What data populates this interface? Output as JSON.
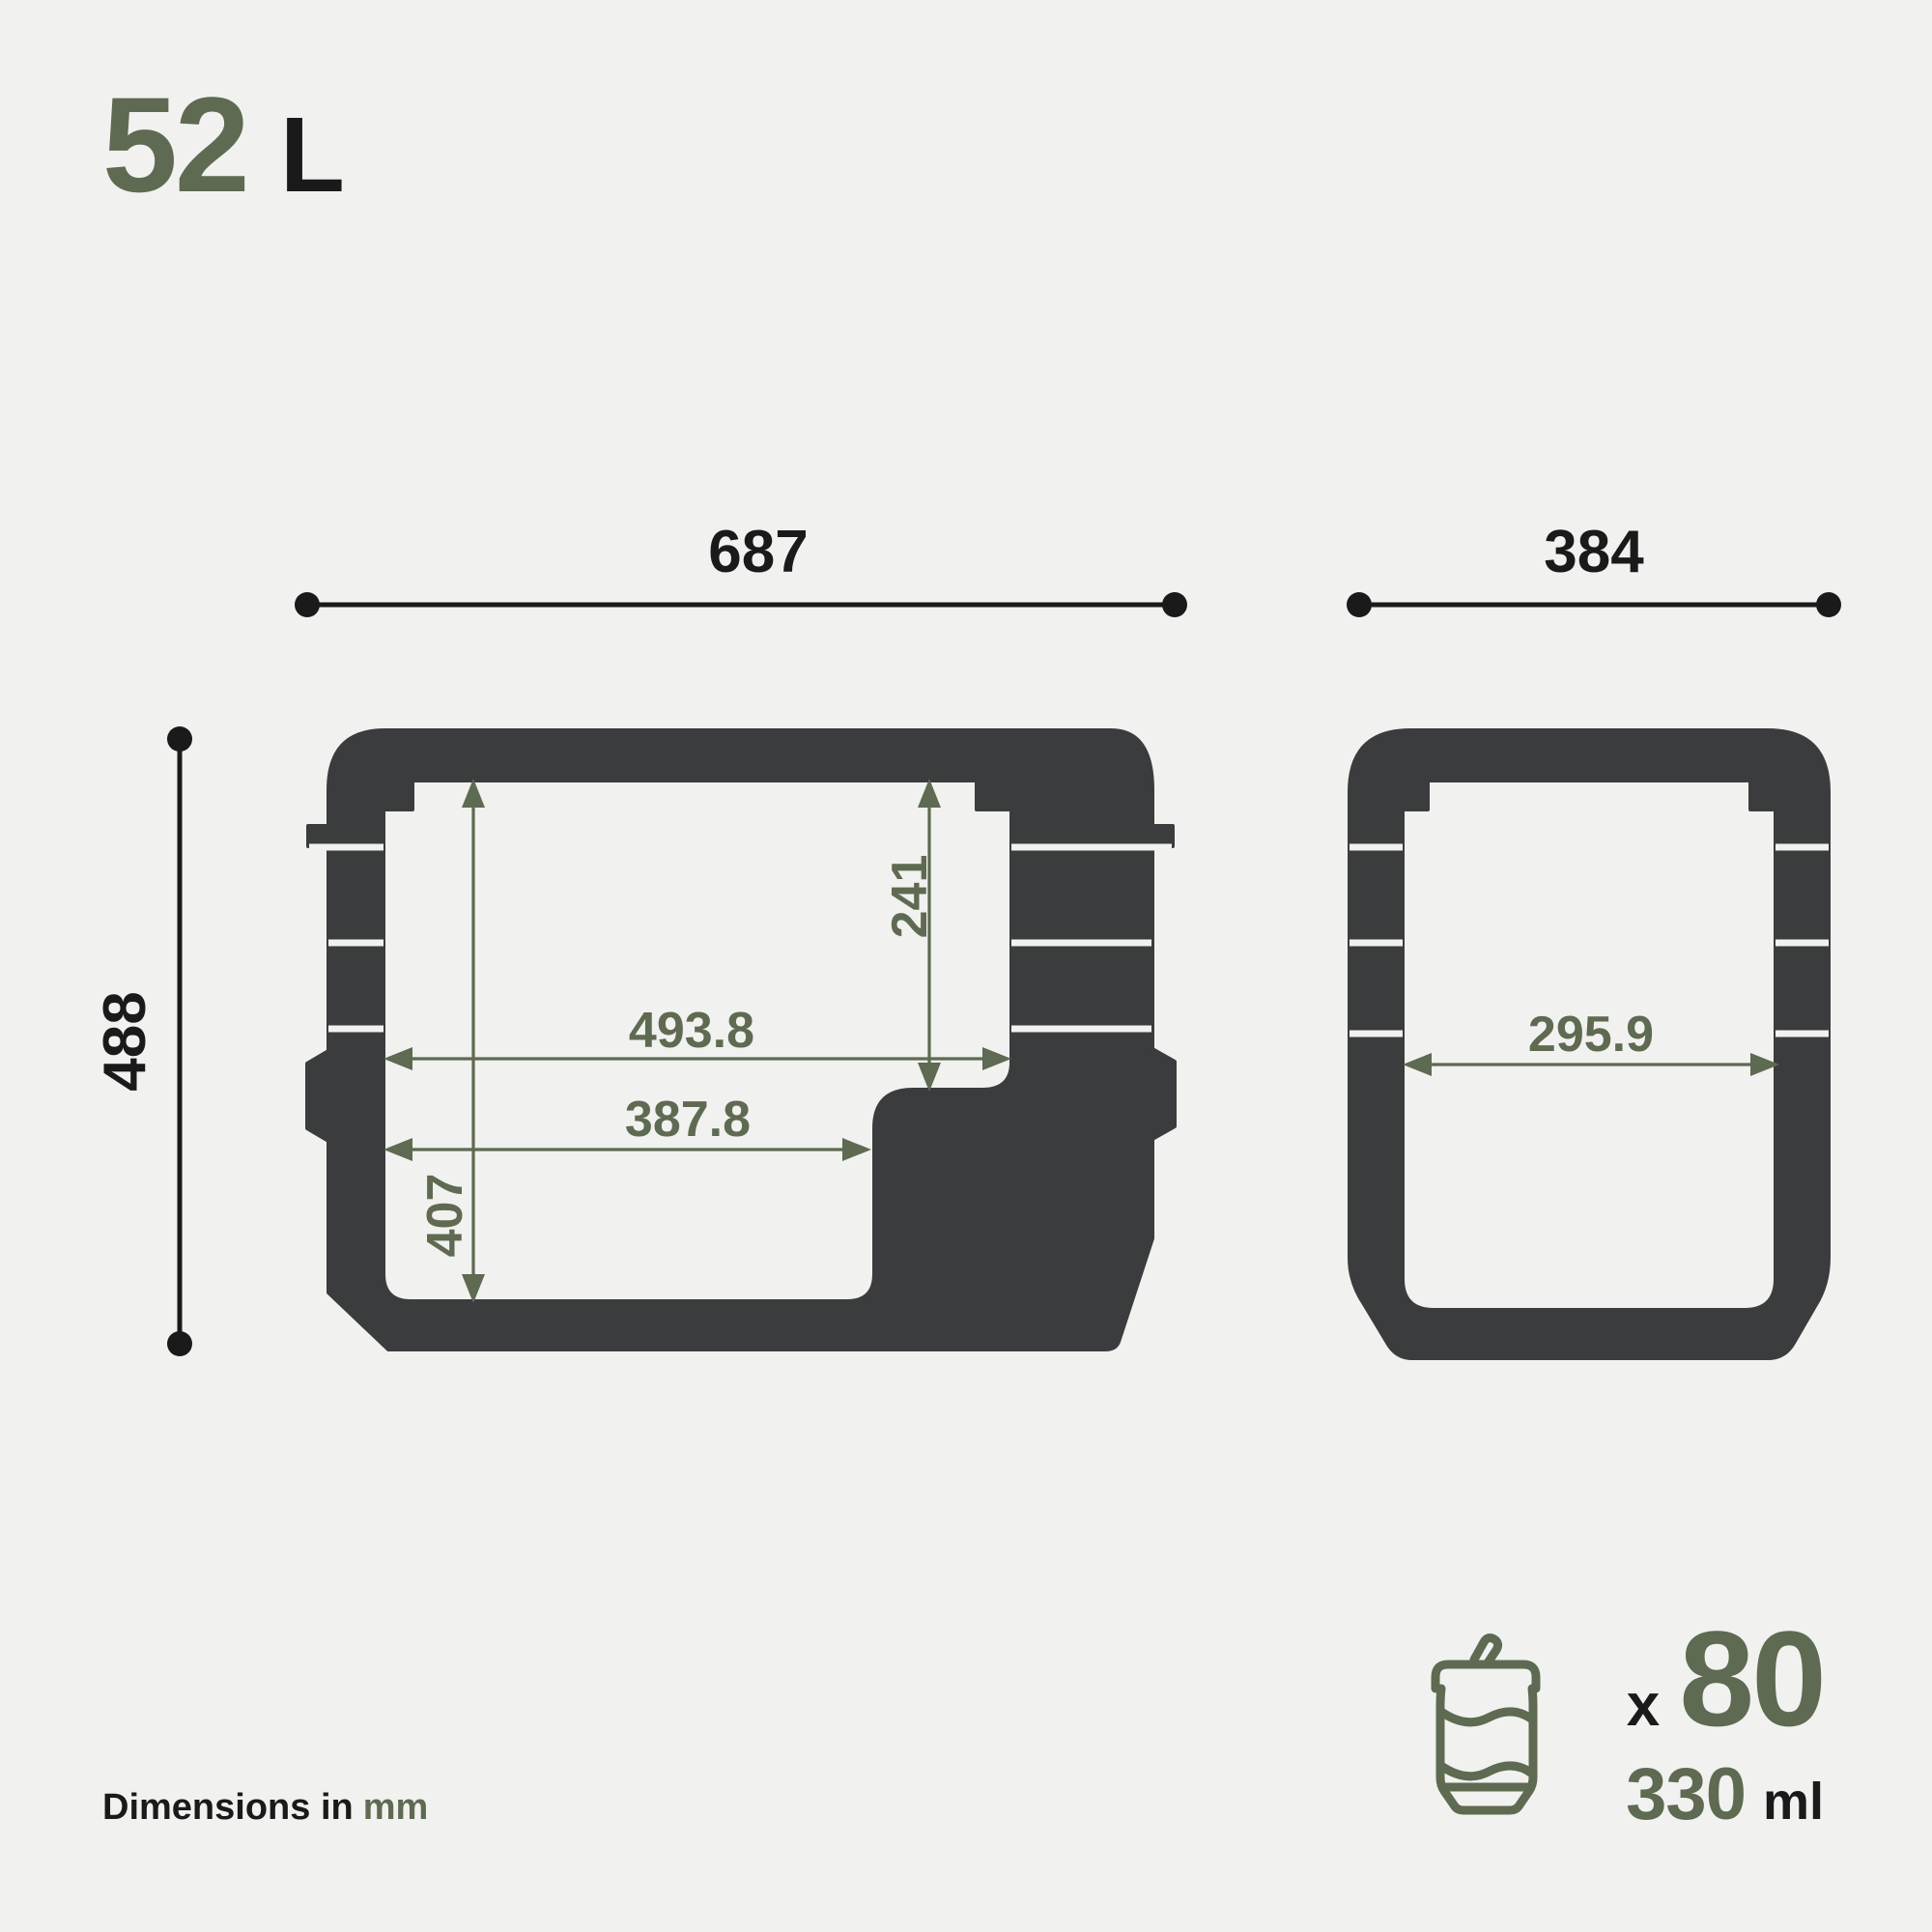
{
  "title": {
    "value": "52",
    "unit": "L"
  },
  "left_view": {
    "outer_width": "687",
    "outer_height": "488",
    "cavity_height": "407",
    "cavity_right_height": "241",
    "cavity_width_top": "493.8",
    "cavity_width_bottom": "387.8"
  },
  "right_view": {
    "outer_width": "384",
    "cavity_width": "295.9"
  },
  "capacity": {
    "multiplier": "x",
    "count": "80",
    "volume": "330",
    "volume_unit": "ml"
  },
  "footer": {
    "text": "Dimensions in",
    "unit": "mm"
  },
  "icons": {
    "can": "soda-can-icon"
  },
  "colors": {
    "background": "#f1f1ef",
    "body": "#3b3c3d",
    "accent": "#5e6a51",
    "ink": "#1a1a1a"
  }
}
